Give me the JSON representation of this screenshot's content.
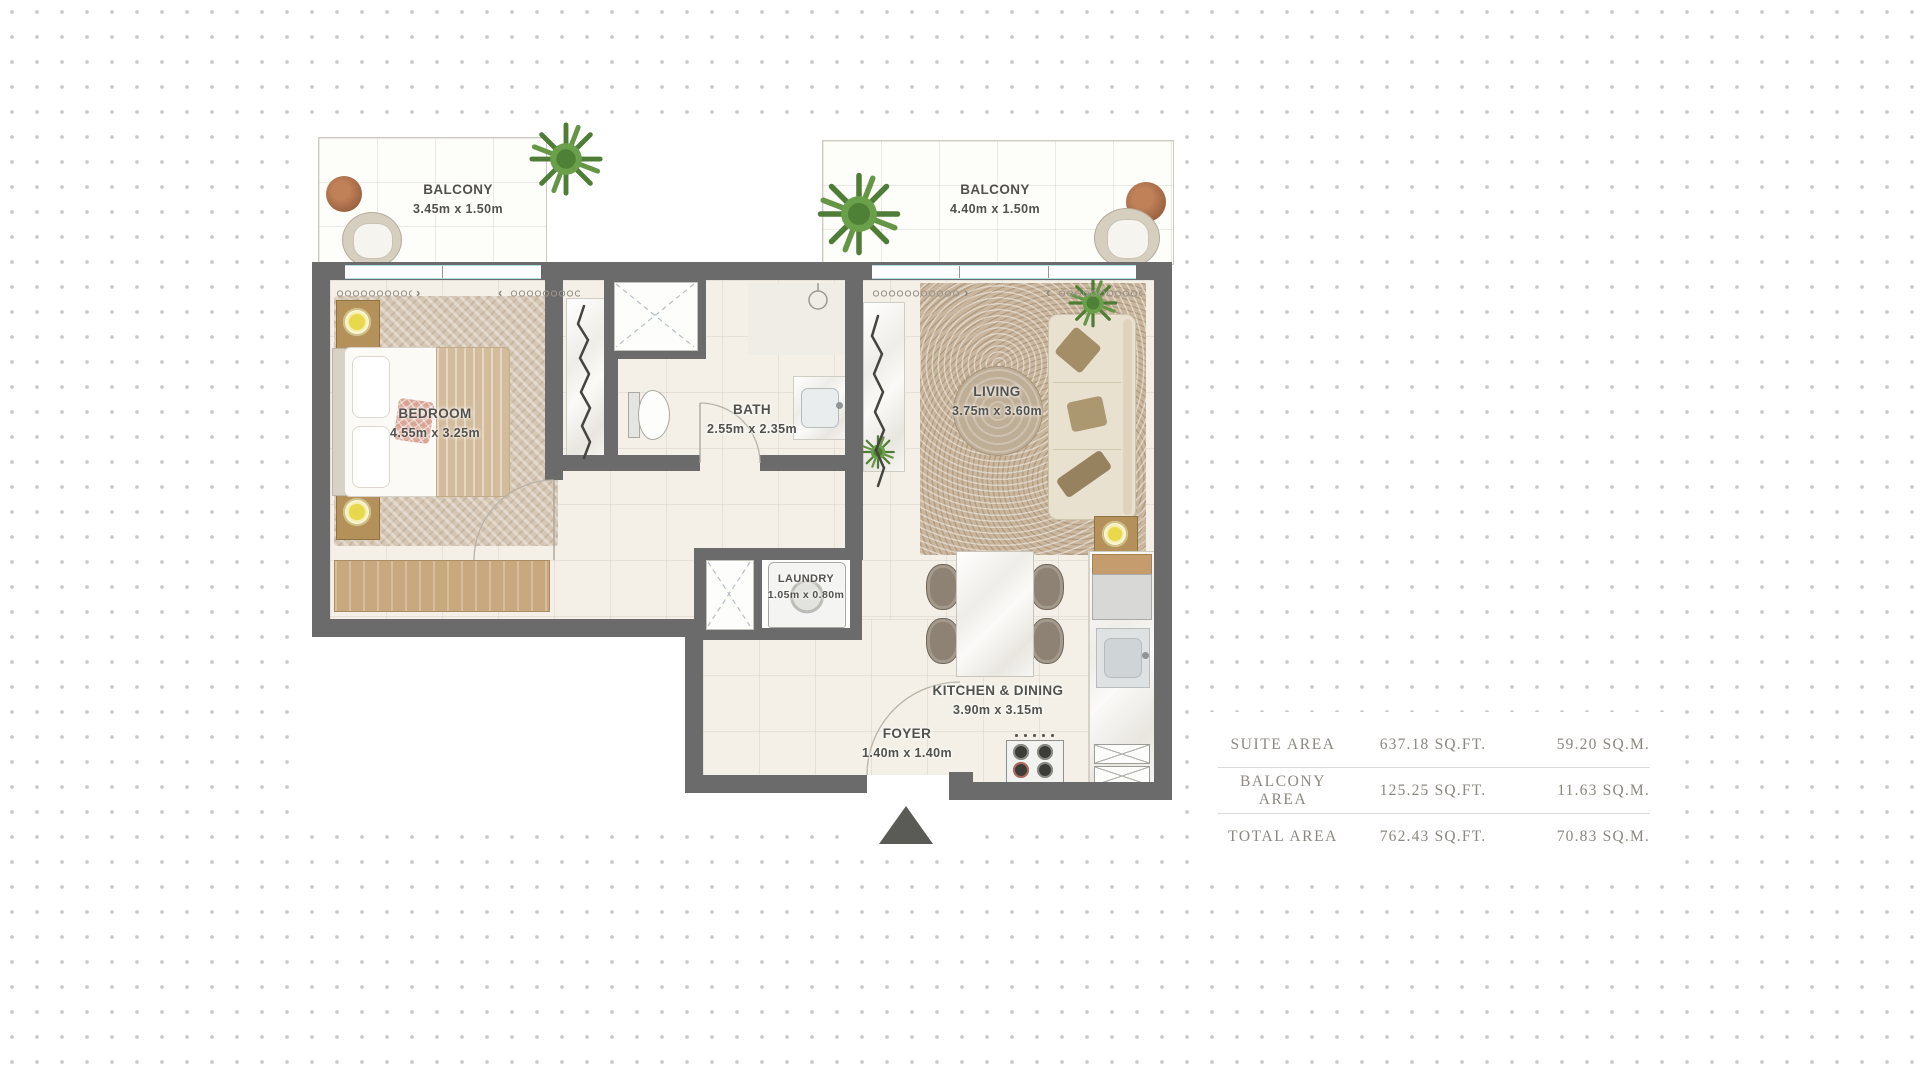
{
  "plan": {
    "rooms": {
      "balcony_left": {
        "name": "BALCONY",
        "dims": "3.45m x 1.50m"
      },
      "balcony_right": {
        "name": "BALCONY",
        "dims": "4.40m x 1.50m"
      },
      "bedroom": {
        "name": "BEDROOM",
        "dims": "4.55m x 3.25m"
      },
      "bath": {
        "name": "BATH",
        "dims": "2.55m x 2.35m"
      },
      "living": {
        "name": "LIVING",
        "dims": "3.75m x 3.60m"
      },
      "laundry": {
        "name": "LAUNDRY",
        "dims": "1.05m x 0.80m"
      },
      "kitchen_dining": {
        "name": "KITCHEN & DINING",
        "dims": "3.90m x 3.15m"
      },
      "foyer": {
        "name": "FOYER",
        "dims": "1.40m x 1.40m"
      }
    },
    "decor": {
      "chevron_left": "‹",
      "chevron_right": "›"
    }
  },
  "area_table": {
    "rows": [
      {
        "label": "SUITE AREA",
        "sqft": "637.18 SQ.FT.",
        "sqm": "59.20 SQ.M."
      },
      {
        "label": "BALCONY AREA",
        "sqft": "125.25 SQ.FT.",
        "sqm": "11.63 SQ.M."
      },
      {
        "label": "TOTAL AREA",
        "sqft": "762.43 SQ.FT.",
        "sqm": "70.83 SQ.M."
      }
    ]
  },
  "colors": {
    "wall": "#6b6b6b",
    "floor": "#f4f0e8",
    "label_text": "#52514c",
    "table_text": "#8b8781",
    "lamp_yellow": "#e8d94c",
    "plant_green": "#6aa04a",
    "wood_brown": "#a96e4f",
    "window_glass": "#b5dfe1",
    "entrance_arrow": "#5a5a57"
  }
}
